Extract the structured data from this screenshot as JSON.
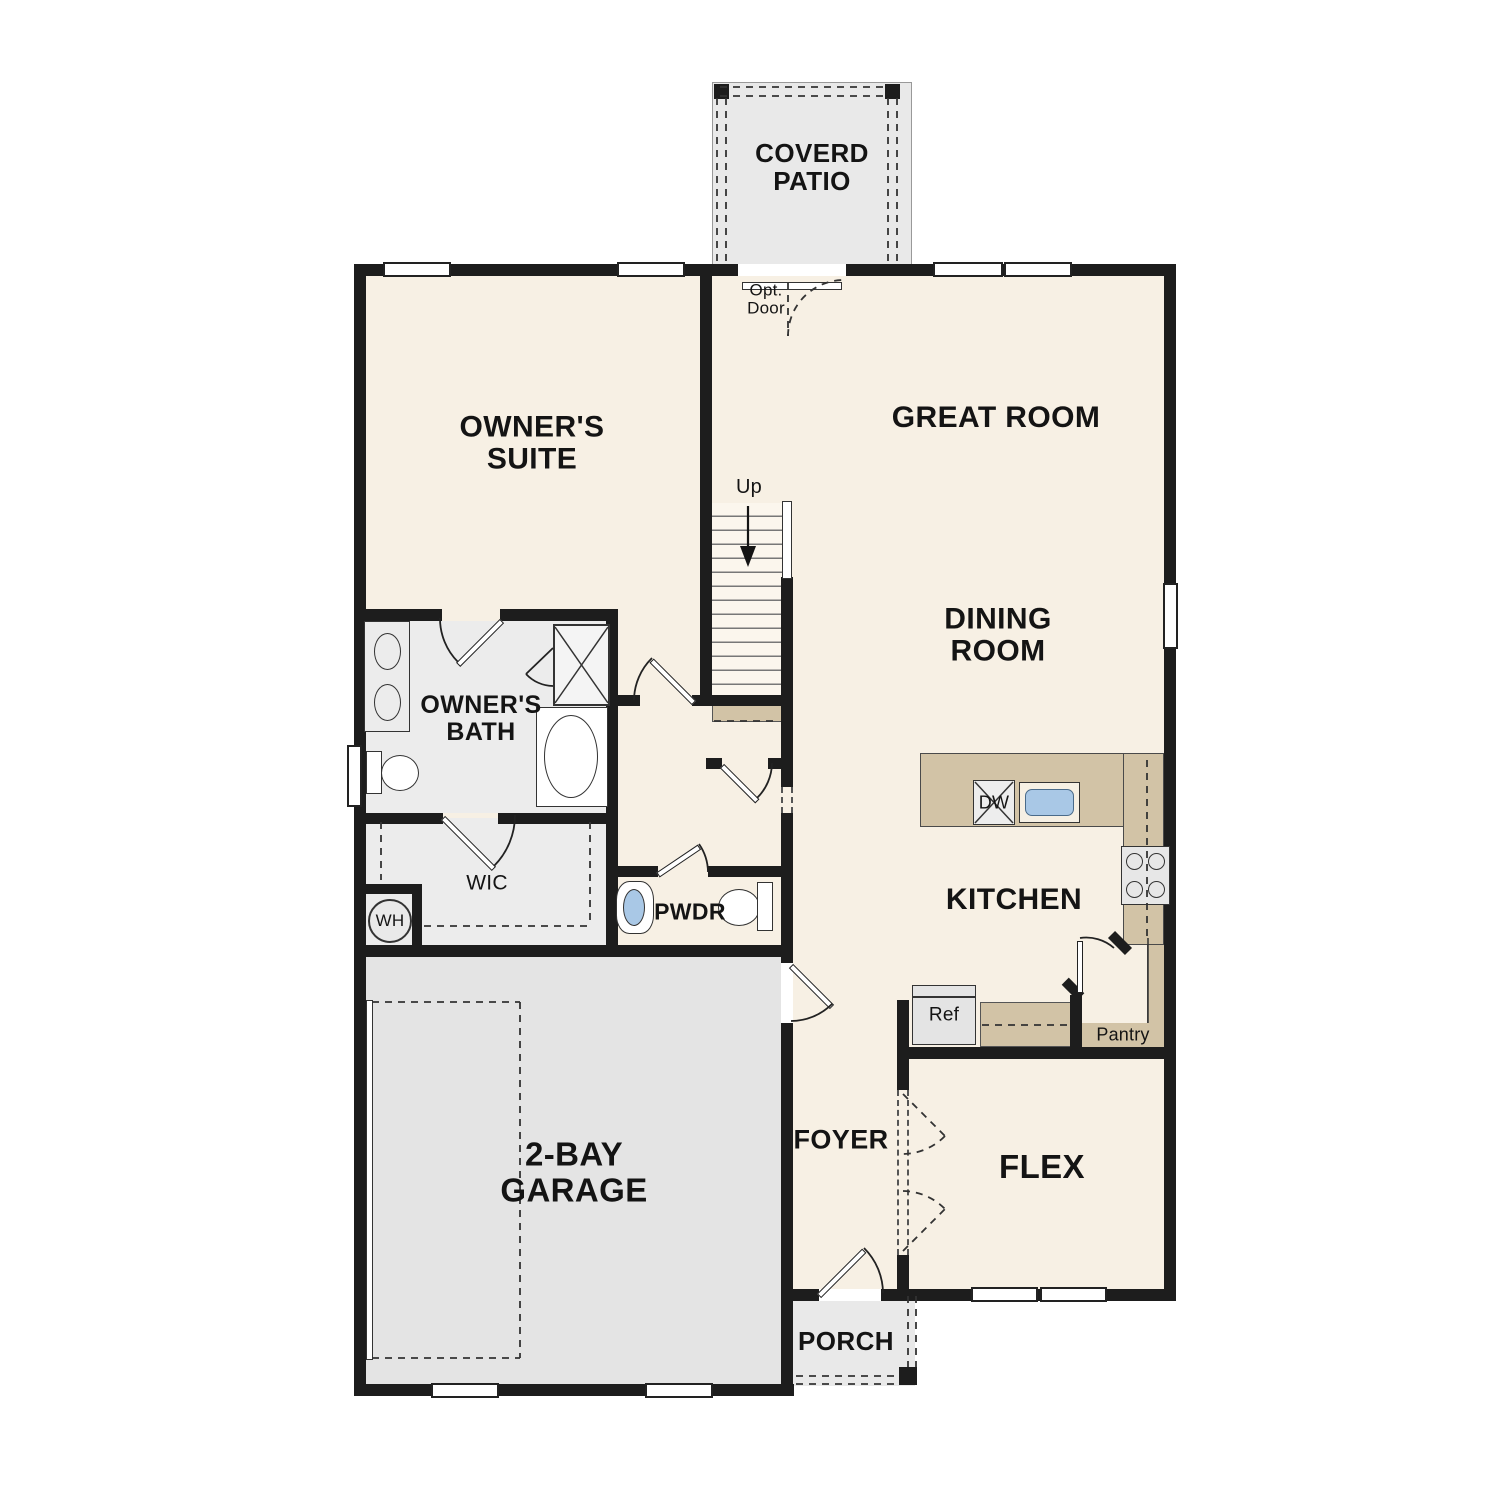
{
  "title": "First Floor Plan",
  "colors": {
    "wall": "#1d1d1d",
    "cream": "#f7f0e4",
    "gray": "#e9e9e9",
    "graymid": "#ececec",
    "garage": "#e4e4e4",
    "tan": "#d2c3a6",
    "blue": "#a9c8e6"
  },
  "rooms": {
    "patio": "COVERD\nPATIO",
    "owners_suite": "OWNER'S\nSUITE",
    "great_room": "GREAT ROOM",
    "dining_room": "DINING\nROOM",
    "owners_bath": "OWNER'S\nBATH",
    "wic": "WIC",
    "pwdr": "PWDR",
    "kitchen": "KITCHEN",
    "garage": "2-BAY\nGARAGE",
    "foyer": "FOYER",
    "flex": "FLEX",
    "porch": "PORCH"
  },
  "annotations": {
    "opt_door": "Opt.\nDoor",
    "up": "Up",
    "wh": "WH",
    "dw": "DW",
    "ref": "Ref",
    "pantry": "Pantry"
  }
}
